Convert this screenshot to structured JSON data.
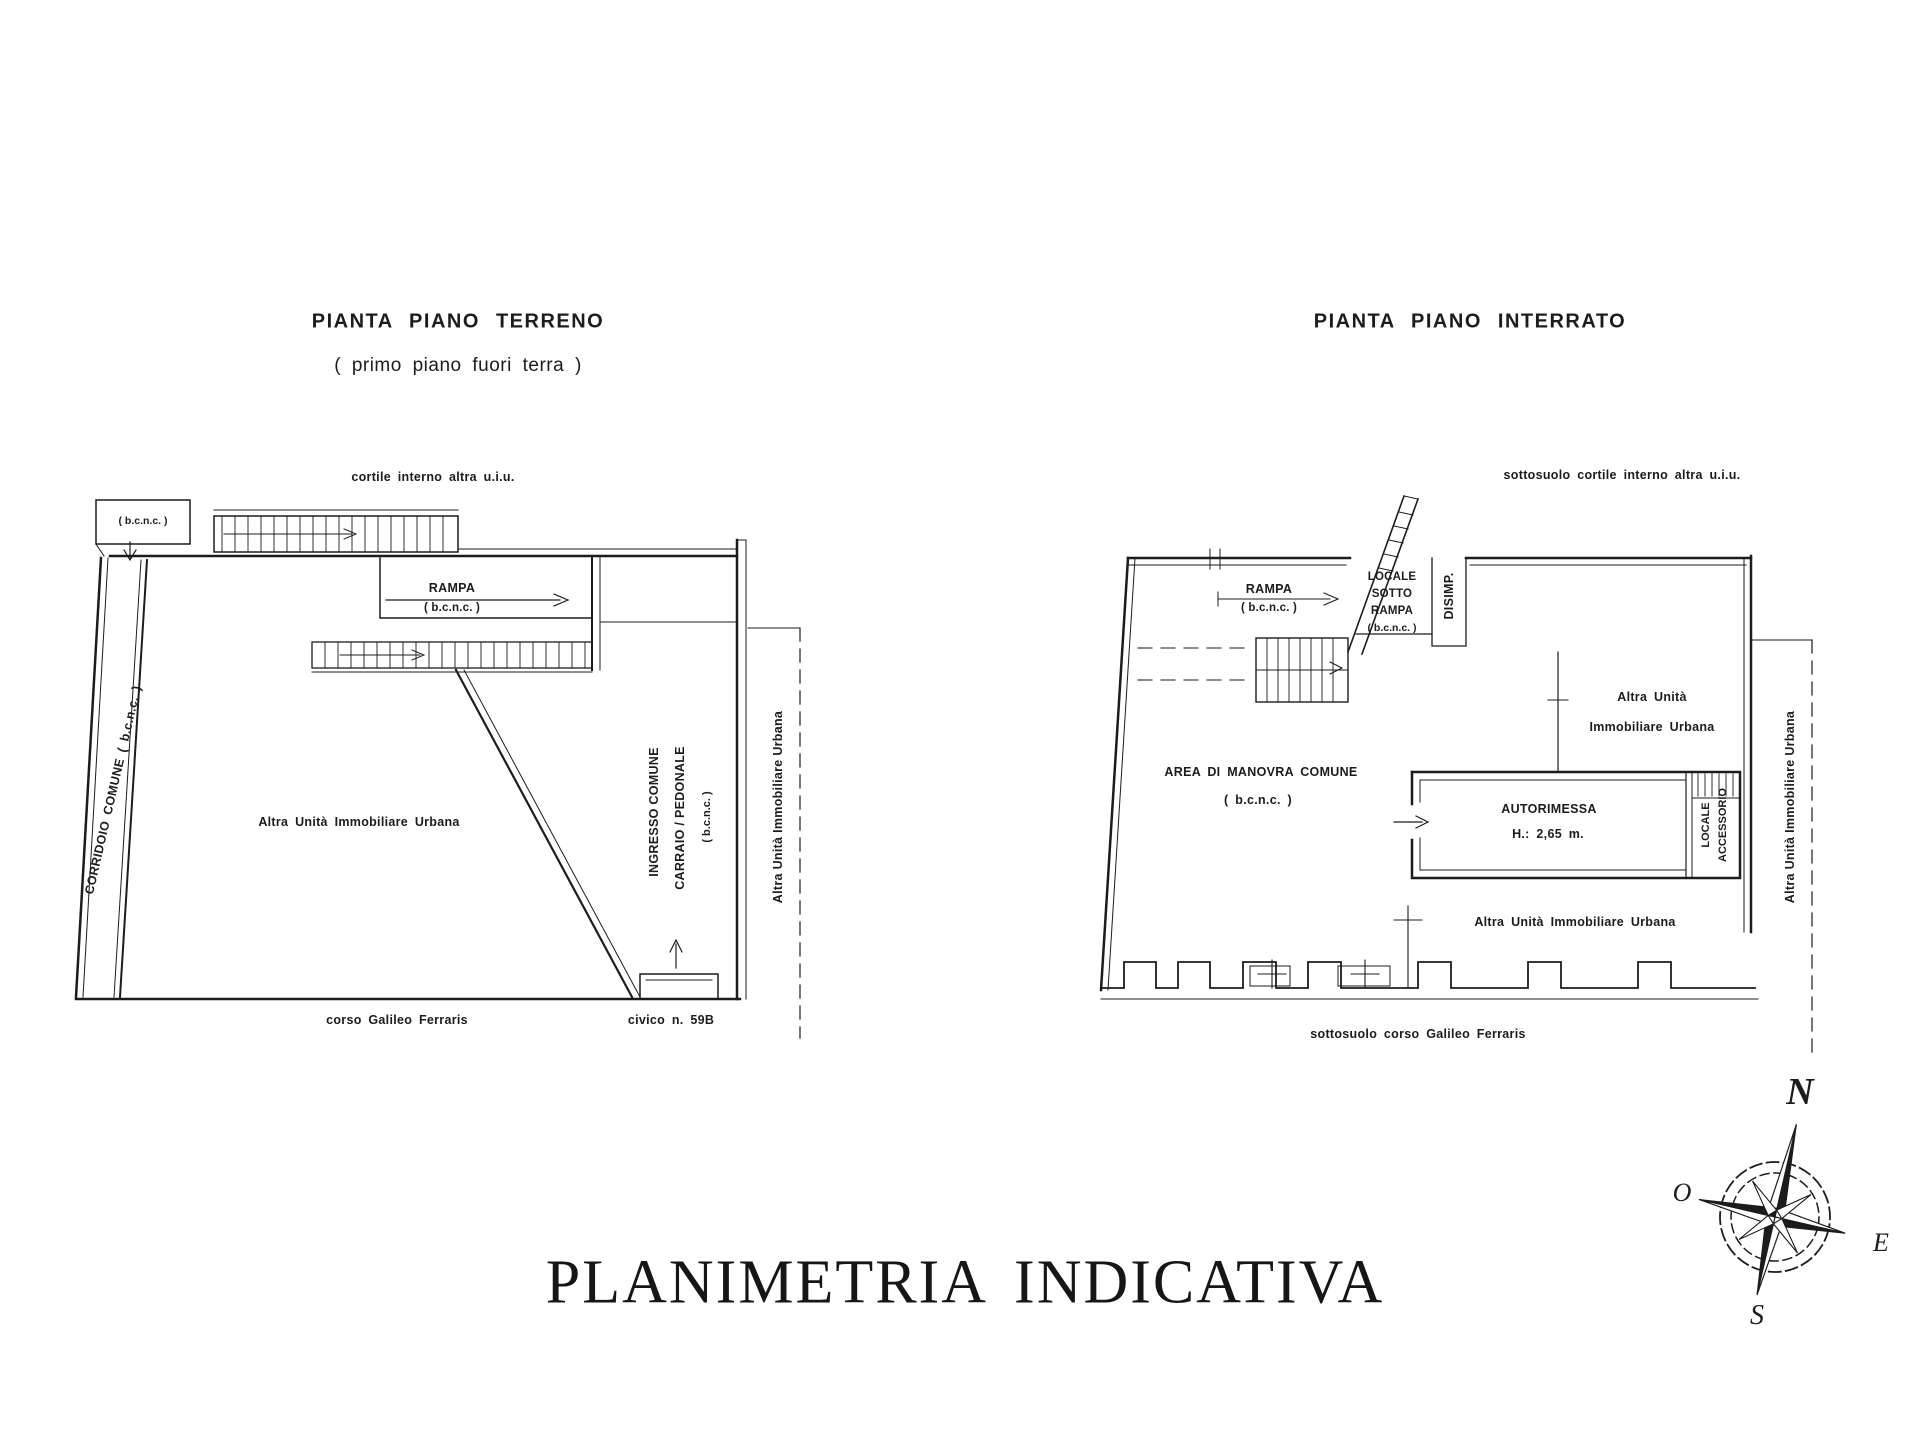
{
  "page": {
    "main_title": "PLANIMETRIA INDICATIVA"
  },
  "left_plan": {
    "title": "PIANTA PIANO TERRENO",
    "subtitle": "( primo piano fuori terra )",
    "labels": {
      "courtyard": "cortile interno altra u.i.u.",
      "bcnc_small": "( b.c.n.c. )",
      "rampa": "RAMPA",
      "rampa_sub": "( b.c.n.c. )",
      "corridoio": "CORRIDOIO COMUNE ( b.c.n.c. )",
      "altra_unita": "Altra Unità Immobiliare Urbana",
      "ingresso_line1": "INGRESSO COMUNE",
      "ingresso_line2": "CARRAIO / PEDONALE",
      "ingresso_line3": "( b.c.n.c. )",
      "altra_unita_right": "Altra Unità Immobiliare Urbana",
      "street": "corso Galileo Ferraris",
      "civic": "civico n. 59B"
    }
  },
  "right_plan": {
    "title": "PIANTA PIANO INTERRATO",
    "labels": {
      "courtyard": "sottosuolo cortile interno altra u.i.u.",
      "rampa": "RAMPA",
      "rampa_sub": "( b.c.n.c. )",
      "locale_sotto_rampa": {
        "l1": "LOCALE",
        "l2": "SOTTO",
        "l3": "RAMPA",
        "l4": "( b.c.n.c. )"
      },
      "disimp": "DISIMP.",
      "altra_unita_top1": "Altra Unità",
      "altra_unita_top2": "Immobiliare Urbana",
      "area_manovra": "AREA DI MANOVRA COMUNE",
      "area_manovra_sub": "( b.c.n.c. )",
      "autorimessa": "AUTORIMESSA",
      "autorimessa_height": "H.: 2,65 m.",
      "locale_accessorio1": "LOCALE",
      "locale_accessorio2": "ACCESSORIO",
      "altra_unita_right": "Altra Unità Immobiliare Urbana",
      "altra_unita_bottom": "Altra Unità Immobiliare Urbana",
      "street": "sottosuolo corso Galileo Ferraris"
    }
  },
  "compass": {
    "north": "N",
    "west": "O",
    "east": "E",
    "south": "S"
  },
  "colors": {
    "ink": "#1c1c1c",
    "paper": "#ffffff"
  }
}
